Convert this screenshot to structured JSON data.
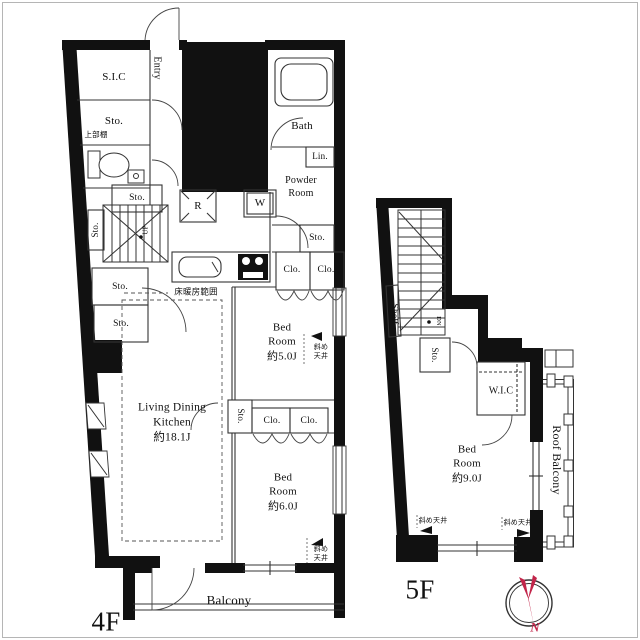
{
  "colors": {
    "wall": "#111111",
    "line": "#333333",
    "compass_needle": "#c2254a",
    "background": "#ffffff"
  },
  "compass": {
    "north": "N"
  },
  "f4": {
    "floor": "4F",
    "sic": "S.I.C",
    "entry": "Entry",
    "sto": "Sto.",
    "upper_shelf": "上部棚",
    "bath": "Bath",
    "linen": "Lin.",
    "powder": "Powder\nRoom",
    "fridge": "R",
    "washer": "W",
    "up": "UP",
    "closet": "Clo.",
    "heating": "床暖房範囲",
    "sloped": "斜め\n天井",
    "bed5": "Bed\nRoom\n約5.0J",
    "bed6": "Bed\nRoom\n約6.0J",
    "ldk": "Living Dining\nKitchen\n約18.1J",
    "balcony": "Balcony"
  },
  "f5": {
    "floor": "5F",
    "shelf": "Shelf",
    "down": "DN",
    "sto": "Sto.",
    "wic": "W.I.C",
    "bed9": "Bed\nRoom\n約9.0J",
    "roof_balcony": "Roof Balcony",
    "sloped": "斜め天井"
  }
}
